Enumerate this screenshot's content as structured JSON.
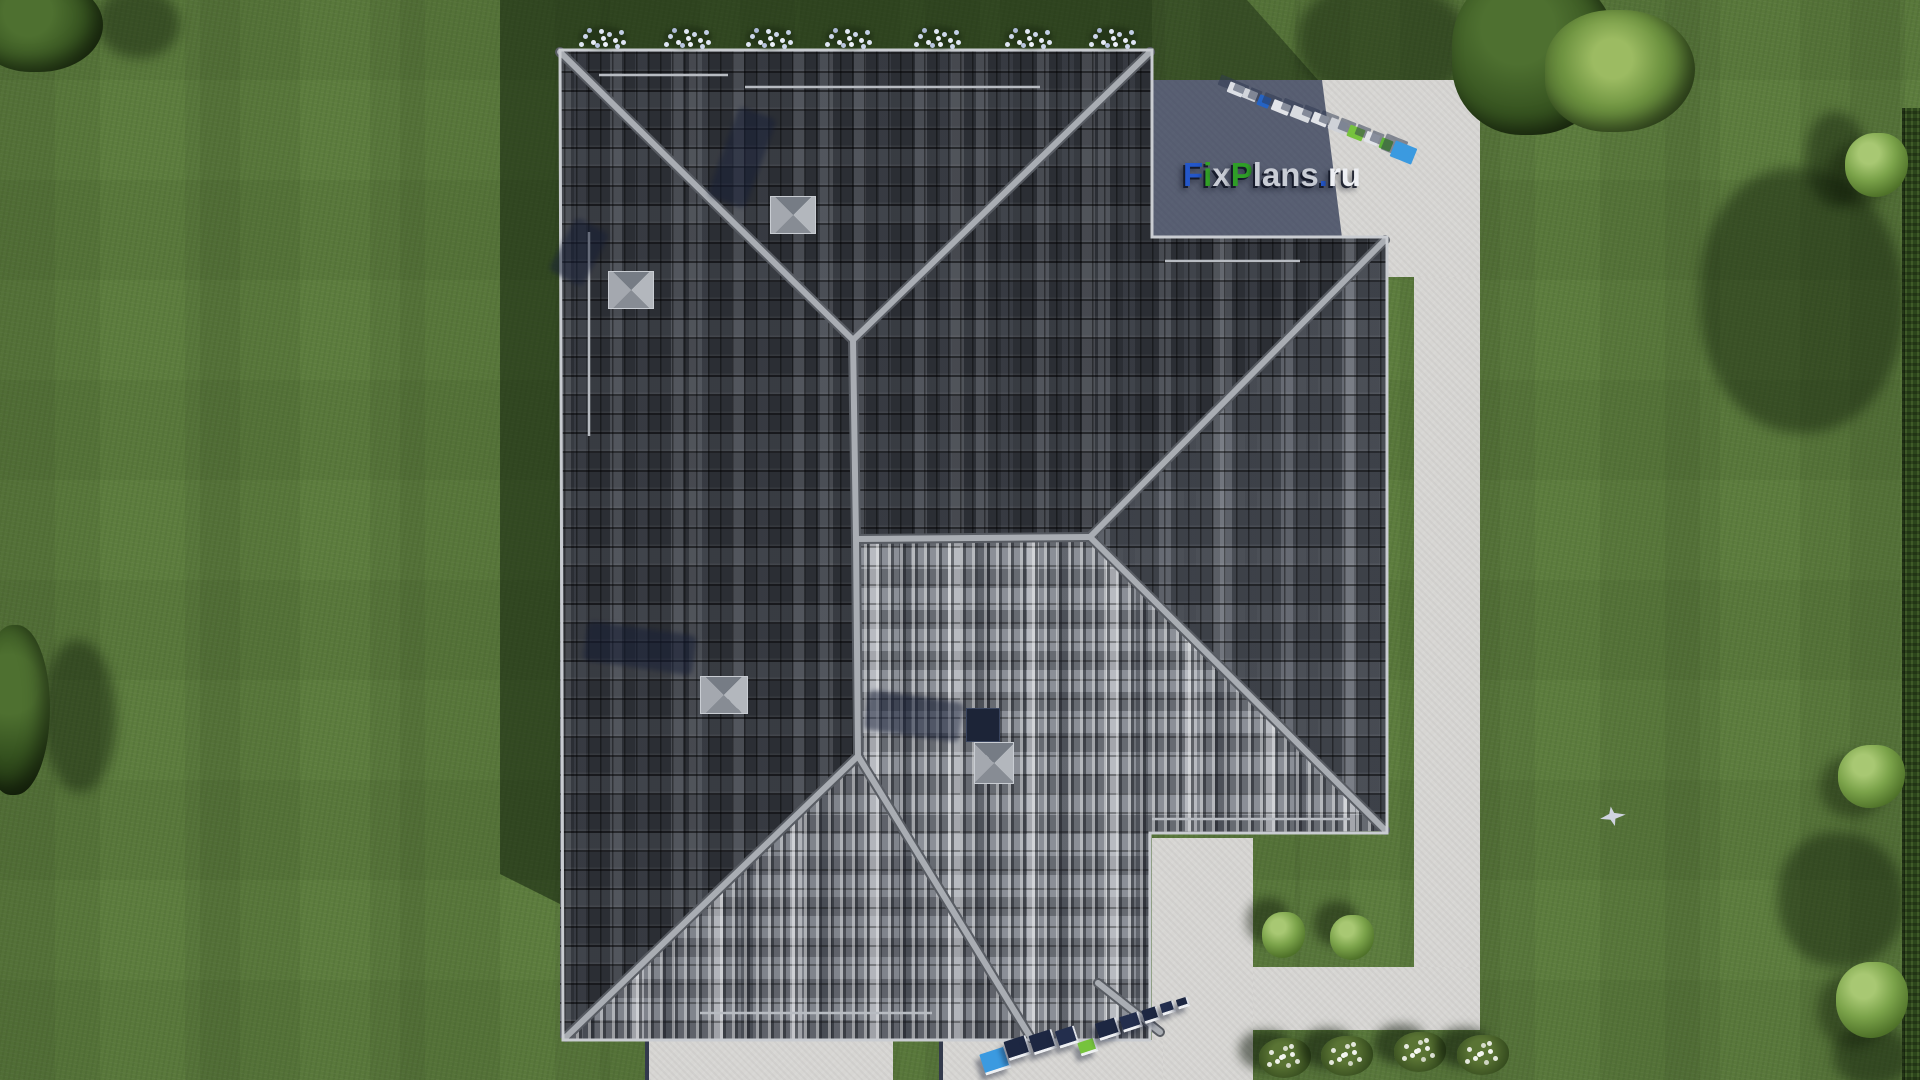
{
  "scene": {
    "description": "Aerial top-down 3D architectural render: dark-tiled hip roof of a house on a mown lawn with L-shaped concrete walkway, patio, bushes and trees",
    "site_brand": "FixPlans.ru"
  },
  "watermark": {
    "main": {
      "text": "FixPlans.ru",
      "segments": [
        {
          "text": "F",
          "color": "#2457c9"
        },
        {
          "text": "i",
          "color": "#33a327"
        },
        {
          "text": "x",
          "color": "#c9cdd6"
        },
        {
          "text": "P",
          "color": "#2f9e27"
        },
        {
          "text": "lans",
          "color": "#c9cdd6"
        },
        {
          "text": ".",
          "color": "#2457c9"
        },
        {
          "text": "ru",
          "color": "#eef0f4"
        }
      ]
    },
    "top_3d_text": "fixplans.ru",
    "bottom_3d_text": "fixplans.ru"
  },
  "palette": {
    "grass_sunlit": "#5d7d3e",
    "grass_shadow": "#2f4620",
    "roof_dark": "#2b2e34",
    "roof_mid": "#3d4148",
    "roof_light": "#80848c",
    "ridge": "#a9adb3",
    "eave": "#c9ccd1",
    "pavement": "#d7d6d3",
    "pavement_in_shadow": "#43506b",
    "chimney_cap": "#9aa0a8",
    "chimney_box_navy": "#1c2437",
    "hedge": "#2c451b",
    "logo_blue": "#2457c9",
    "logo_green": "#33a327",
    "block_sky_blue": "#3b9ae0",
    "block_navy": "#1d2742"
  },
  "objects": {
    "chimney_count": 4,
    "roofline_flower_clusters": [
      603,
      688,
      770,
      849,
      938,
      1029,
      1113
    ],
    "round_bushes_by_walkway": 2,
    "white_flower_bushes_bottom": 4,
    "bird": {
      "x": 1610,
      "y": 815
    }
  },
  "logo3d": {
    "top": {
      "blocks": [
        {
          "x": 1228,
          "y": 84,
          "w": 16,
          "h": 11,
          "c": "#dde0e6"
        },
        {
          "x": 1243,
          "y": 90,
          "w": 14,
          "h": 10,
          "c": "#d2d5db"
        },
        {
          "x": 1258,
          "y": 96,
          "w": 12,
          "h": 11,
          "c": "#2563c4"
        },
        {
          "x": 1272,
          "y": 102,
          "w": 18,
          "h": 11,
          "c": "#e2e4e9"
        },
        {
          "x": 1291,
          "y": 108,
          "w": 20,
          "h": 12,
          "c": "#d8dbe0"
        },
        {
          "x": 1312,
          "y": 114,
          "w": 16,
          "h": 11,
          "c": "#e2e4e9"
        },
        {
          "x": 1329,
          "y": 120,
          "w": 18,
          "h": 12,
          "c": "#cfd2d8"
        },
        {
          "x": 1348,
          "y": 127,
          "w": 16,
          "h": 12,
          "c": "#76c33d"
        },
        {
          "x": 1365,
          "y": 133,
          "w": 14,
          "h": 11,
          "c": "#e2e4e9"
        },
        {
          "x": 1380,
          "y": 139,
          "w": 12,
          "h": 11,
          "c": "#5cb335"
        },
        {
          "x": 1392,
          "y": 144,
          "w": 23,
          "h": 17,
          "c": "#3b9ae0"
        }
      ]
    },
    "bottom": {
      "blocks": [
        {
          "x": 982,
          "y": 1050,
          "w": 27,
          "h": 22,
          "c": "#3b9ae0"
        },
        {
          "x": 1006,
          "y": 1038,
          "w": 23,
          "h": 20,
          "c": "#1d2742"
        },
        {
          "x": 1031,
          "y": 1032,
          "w": 24,
          "h": 20,
          "c": "#1d2742"
        },
        {
          "x": 1057,
          "y": 1028,
          "w": 20,
          "h": 18,
          "c": "#232e4d"
        },
        {
          "x": 1079,
          "y": 1040,
          "w": 18,
          "h": 14,
          "c": "#76c33d"
        },
        {
          "x": 1097,
          "y": 1020,
          "w": 22,
          "h": 18,
          "c": "#1d2742"
        },
        {
          "x": 1121,
          "y": 1014,
          "w": 20,
          "h": 16,
          "c": "#232e4d"
        },
        {
          "x": 1143,
          "y": 1008,
          "w": 16,
          "h": 14,
          "c": "#1d2742"
        },
        {
          "x": 1161,
          "y": 1002,
          "w": 14,
          "h": 12,
          "c": "#232e4d"
        },
        {
          "x": 1177,
          "y": 998,
          "w": 12,
          "h": 10,
          "c": "#1d2742"
        }
      ]
    }
  }
}
